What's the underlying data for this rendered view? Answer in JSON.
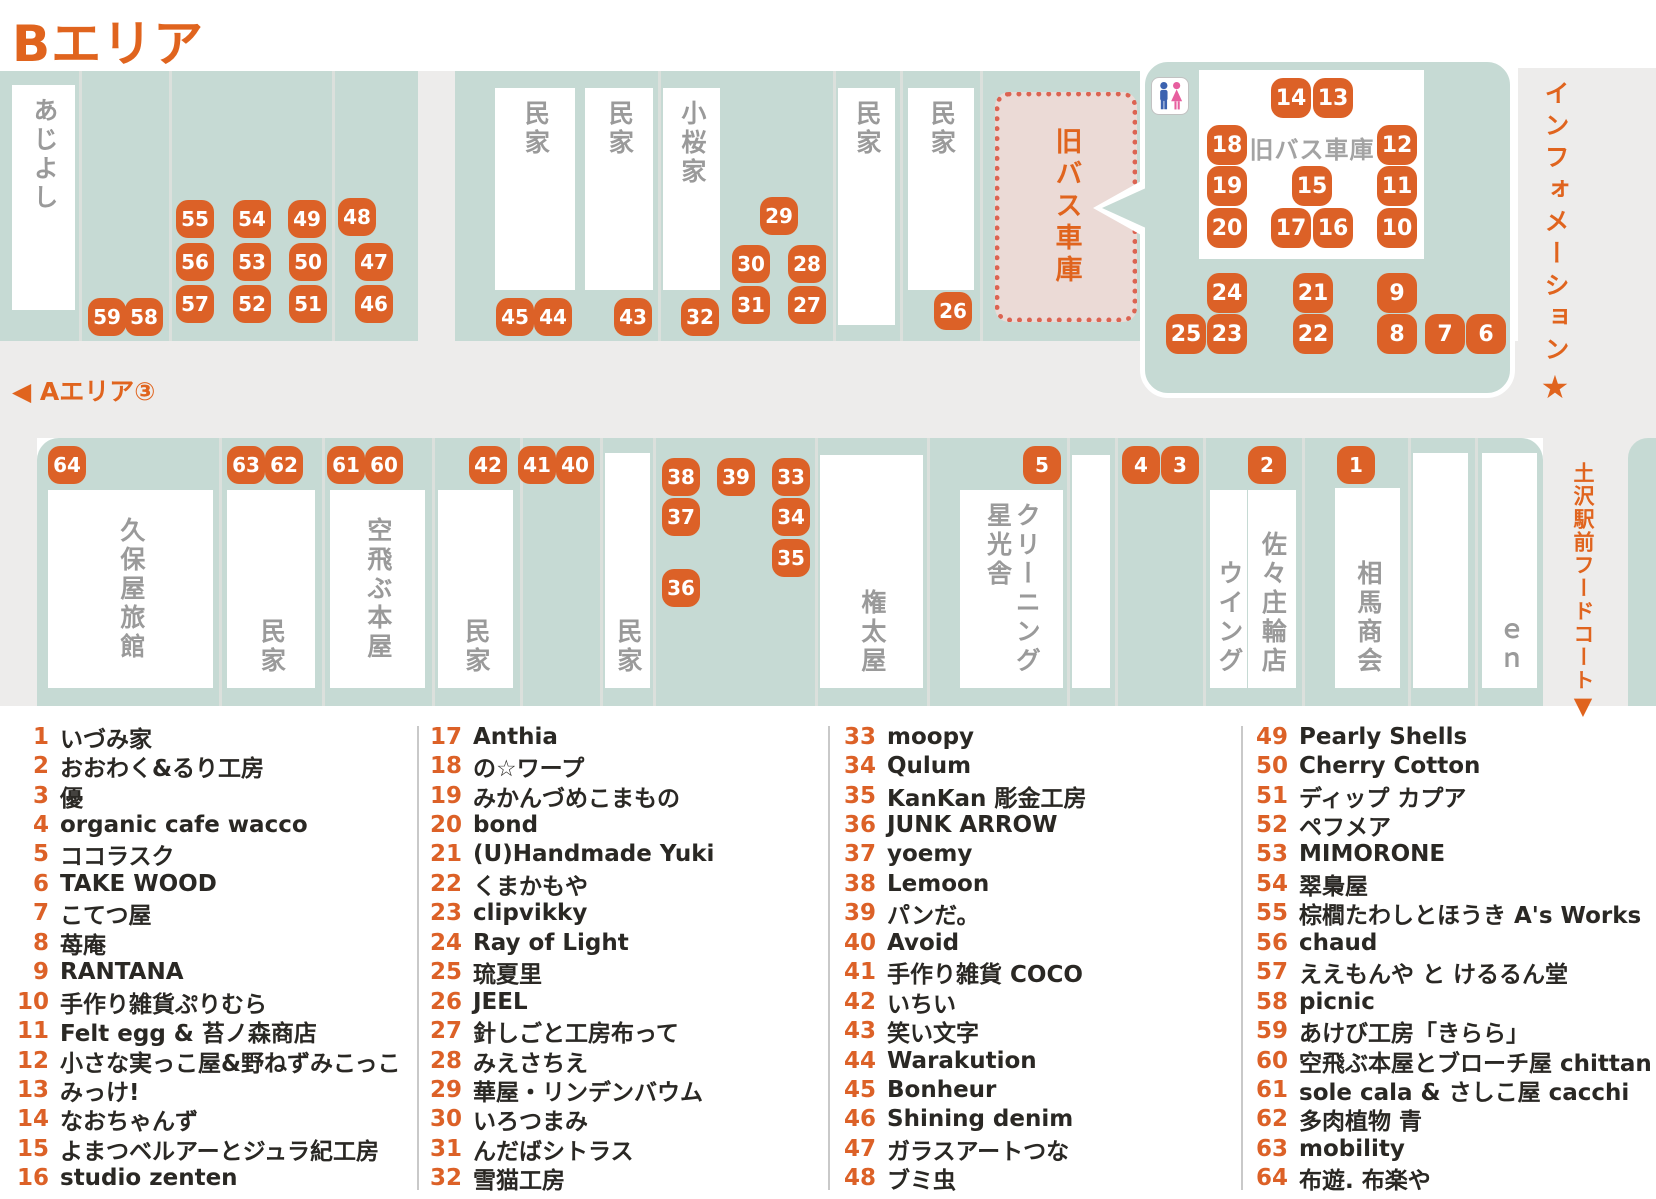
{
  "title": "Bエリア",
  "nav": {
    "a_area_label": "◀ Aエリア③",
    "information_label": "インフォメーション",
    "information_star": "★",
    "foodcourt_label": "土沢駅前フードコート",
    "foodcourt_arrow": "▼"
  },
  "colors": {
    "accent_orange": "#e0641e",
    "badge_orange": "#dc6127",
    "street_teal": "#c6dad4",
    "road_gray": "#edeceb",
    "garage_pink_fill": "#ebdad6",
    "garage_pink_dot": "#dc6351",
    "building_text_gray": "#9a9a9a",
    "legend_text": "#2a2824",
    "restroom_blue": "#3c63b0",
    "restroom_pink": "#e75f9f"
  },
  "map": {
    "bus_garage": {
      "label": "旧バス車庫"
    },
    "callout": {
      "building_label": "旧バス車庫",
      "toilet_icon": "male-female-restroom-icon"
    },
    "roads": [
      {
        "x": 418,
        "y": 71,
        "w": 37,
        "h": 270
      },
      {
        "x": 0,
        "y": 341,
        "w": 1656,
        "h": 97
      },
      {
        "x": 1518,
        "y": 68,
        "w": 138,
        "h": 273
      },
      {
        "x": 1543,
        "y": 438,
        "w": 113,
        "h": 268
      },
      {
        "x": 0,
        "y": 438,
        "w": 37,
        "h": 268
      }
    ],
    "teal_blocks": [
      {
        "x": 0,
        "y": 71,
        "w": 418,
        "h": 270
      },
      {
        "x": 455,
        "y": 71,
        "w": 525,
        "h": 270
      },
      {
        "x": 980,
        "y": 71,
        "w": 160,
        "h": 270
      },
      {
        "x": 37,
        "y": 438,
        "w": 1506,
        "h": 268,
        "r": "22px 22px 0 0"
      },
      {
        "x": 1628,
        "y": 438,
        "w": 28,
        "h": 268,
        "r": "20px 0 0 0"
      }
    ],
    "dividers": [
      {
        "x": 79,
        "y": 71,
        "h": 270
      },
      {
        "x": 169,
        "y": 71,
        "h": 270
      },
      {
        "x": 332,
        "y": 71,
        "h": 270
      },
      {
        "x": 658,
        "y": 71,
        "h": 270
      },
      {
        "x": 833,
        "y": 71,
        "h": 270
      },
      {
        "x": 900,
        "y": 71,
        "h": 270
      },
      {
        "x": 980,
        "y": 71,
        "h": 270
      },
      {
        "x": 219,
        "y": 438,
        "h": 268
      },
      {
        "x": 322,
        "y": 438,
        "h": 268
      },
      {
        "x": 432,
        "y": 438,
        "h": 268
      },
      {
        "x": 520,
        "y": 438,
        "h": 268
      },
      {
        "x": 600,
        "y": 438,
        "h": 268
      },
      {
        "x": 653,
        "y": 438,
        "h": 268
      },
      {
        "x": 815,
        "y": 438,
        "h": 268
      },
      {
        "x": 927,
        "y": 438,
        "h": 268
      },
      {
        "x": 1067,
        "y": 438,
        "h": 268
      },
      {
        "x": 1115,
        "y": 438,
        "h": 268
      },
      {
        "x": 1203,
        "y": 438,
        "h": 268
      },
      {
        "x": 1302,
        "y": 438,
        "h": 268
      },
      {
        "x": 1408,
        "y": 438,
        "h": 268
      },
      {
        "x": 1475,
        "y": 438,
        "h": 268
      }
    ],
    "buildings": [
      {
        "id": "ajiyoshi",
        "label": "あじよし",
        "x": 12,
        "y": 85,
        "w": 63,
        "h": 225,
        "align": "top"
      },
      {
        "id": "minka-t1",
        "label": "民家",
        "x": 495,
        "y": 88,
        "w": 80,
        "h": 202,
        "align": "top"
      },
      {
        "id": "minka-t2",
        "label": "民家",
        "x": 585,
        "y": 88,
        "w": 68,
        "h": 202,
        "align": "top"
      },
      {
        "id": "kozakuraya",
        "label": "小桜家",
        "x": 663,
        "y": 88,
        "w": 57,
        "h": 202,
        "align": "top"
      },
      {
        "id": "minka-t3",
        "label": "民家",
        "x": 838,
        "y": 88,
        "w": 57,
        "h": 237,
        "align": "top"
      },
      {
        "id": "minka-t4",
        "label": "民家",
        "x": 908,
        "y": 88,
        "w": 66,
        "h": 202,
        "align": "top"
      },
      {
        "id": "kuboya-ryokan",
        "label": "久保屋旅館",
        "x": 48,
        "y": 490,
        "w": 165,
        "h": 198,
        "align": "center"
      },
      {
        "id": "minka-b1",
        "label": "民家",
        "x": 227,
        "y": 490,
        "w": 88,
        "h": 198,
        "align": "bottom"
      },
      {
        "id": "soratobu-honya",
        "label": "空飛ぶ本屋",
        "x": 330,
        "y": 490,
        "w": 95,
        "h": 198,
        "align": "center"
      },
      {
        "id": "minka-b2",
        "label": "民家",
        "x": 438,
        "y": 490,
        "w": 75,
        "h": 198,
        "align": "bottom"
      },
      {
        "id": "minka-b3",
        "label": "民家",
        "x": 605,
        "y": 453,
        "w": 45,
        "h": 235,
        "align": "bottom"
      },
      {
        "id": "gontaya",
        "label": "権太屋",
        "x": 820,
        "y": 455,
        "w": 103,
        "h": 233,
        "align": "bottom"
      },
      {
        "id": "cleaning-seikosha",
        "label": "クリーニング\n星光舎",
        "x": 960,
        "y": 490,
        "w": 103,
        "h": 198,
        "align": "bottom"
      },
      {
        "id": "unlabeled-1",
        "label": "",
        "x": 1072,
        "y": 455,
        "w": 38,
        "h": 233,
        "align": "bottom"
      },
      {
        "id": "wing",
        "label": "ウイング",
        "x": 1210,
        "y": 490,
        "w": 37,
        "h": 198,
        "align": "bottom"
      },
      {
        "id": "sasasho-rinten",
        "label": "佐々庄輪店",
        "x": 1248,
        "y": 490,
        "w": 48,
        "h": 198,
        "align": "bottom"
      },
      {
        "id": "soma-shokai",
        "label": "相馬商会",
        "x": 1335,
        "y": 488,
        "w": 65,
        "h": 200,
        "align": "bottom"
      },
      {
        "id": "unlabeled-2",
        "label": "",
        "x": 1413,
        "y": 453,
        "w": 55,
        "h": 235,
        "align": "bottom"
      },
      {
        "id": "en",
        "label": "ｅｎ",
        "x": 1482,
        "y": 453,
        "w": 55,
        "h": 235,
        "align": "bottom"
      }
    ],
    "badges": [
      {
        "n": 1,
        "x": 1356,
        "y": 465,
        "s": 38
      },
      {
        "n": 2,
        "x": 1267,
        "y": 465,
        "s": 38
      },
      {
        "n": 3,
        "x": 1180,
        "y": 465,
        "s": 38
      },
      {
        "n": 4,
        "x": 1141,
        "y": 465,
        "s": 38
      },
      {
        "n": 5,
        "x": 1042,
        "y": 465,
        "s": 38
      },
      {
        "n": 6,
        "x": 1486,
        "y": 334,
        "s": 40
      },
      {
        "n": 7,
        "x": 1445,
        "y": 334,
        "s": 40
      },
      {
        "n": 8,
        "x": 1397,
        "y": 334,
        "s": 40
      },
      {
        "n": 9,
        "x": 1397,
        "y": 293,
        "s": 40
      },
      {
        "n": 10,
        "x": 1397,
        "y": 228,
        "s": 40
      },
      {
        "n": 11,
        "x": 1397,
        "y": 186,
        "s": 40
      },
      {
        "n": 12,
        "x": 1397,
        "y": 145,
        "s": 40
      },
      {
        "n": 13,
        "x": 1333,
        "y": 98,
        "s": 40
      },
      {
        "n": 14,
        "x": 1291,
        "y": 98,
        "s": 40
      },
      {
        "n": 15,
        "x": 1312,
        "y": 186,
        "s": 40
      },
      {
        "n": 16,
        "x": 1333,
        "y": 228,
        "s": 40
      },
      {
        "n": 17,
        "x": 1291,
        "y": 228,
        "s": 40
      },
      {
        "n": 18,
        "x": 1227,
        "y": 145,
        "s": 40
      },
      {
        "n": 19,
        "x": 1227,
        "y": 186,
        "s": 40
      },
      {
        "n": 20,
        "x": 1227,
        "y": 228,
        "s": 40
      },
      {
        "n": 21,
        "x": 1313,
        "y": 293,
        "s": 40
      },
      {
        "n": 22,
        "x": 1313,
        "y": 334,
        "s": 40
      },
      {
        "n": 23,
        "x": 1227,
        "y": 334,
        "s": 40
      },
      {
        "n": 24,
        "x": 1227,
        "y": 293,
        "s": 40
      },
      {
        "n": 25,
        "x": 1186,
        "y": 334,
        "s": 40
      },
      {
        "n": 26,
        "x": 953,
        "y": 311,
        "s": 38
      },
      {
        "n": 27,
        "x": 807,
        "y": 305,
        "s": 38
      },
      {
        "n": 28,
        "x": 807,
        "y": 264,
        "s": 38
      },
      {
        "n": 29,
        "x": 779,
        "y": 216,
        "s": 38
      },
      {
        "n": 30,
        "x": 751,
        "y": 264,
        "s": 38
      },
      {
        "n": 31,
        "x": 751,
        "y": 305,
        "s": 38
      },
      {
        "n": 32,
        "x": 700,
        "y": 317,
        "s": 38
      },
      {
        "n": 33,
        "x": 791,
        "y": 477,
        "s": 38
      },
      {
        "n": 34,
        "x": 791,
        "y": 517,
        "s": 38
      },
      {
        "n": 35,
        "x": 791,
        "y": 558,
        "s": 38
      },
      {
        "n": 36,
        "x": 681,
        "y": 588,
        "s": 38
      },
      {
        "n": 37,
        "x": 681,
        "y": 517,
        "s": 38
      },
      {
        "n": 38,
        "x": 681,
        "y": 477,
        "s": 38
      },
      {
        "n": 39,
        "x": 736,
        "y": 477,
        "s": 38
      },
      {
        "n": 40,
        "x": 575,
        "y": 465,
        "s": 38
      },
      {
        "n": 41,
        "x": 537,
        "y": 465,
        "s": 38
      },
      {
        "n": 42,
        "x": 488,
        "y": 465,
        "s": 38
      },
      {
        "n": 43,
        "x": 633,
        "y": 317,
        "s": 38
      },
      {
        "n": 44,
        "x": 553,
        "y": 317,
        "s": 38
      },
      {
        "n": 45,
        "x": 515,
        "y": 317,
        "s": 38
      },
      {
        "n": 46,
        "x": 374,
        "y": 304,
        "s": 38
      },
      {
        "n": 47,
        "x": 374,
        "y": 262,
        "s": 38
      },
      {
        "n": 48,
        "x": 357,
        "y": 217,
        "s": 38
      },
      {
        "n": 49,
        "x": 307,
        "y": 219,
        "s": 38
      },
      {
        "n": 50,
        "x": 308,
        "y": 262,
        "s": 38
      },
      {
        "n": 51,
        "x": 308,
        "y": 304,
        "s": 38
      },
      {
        "n": 52,
        "x": 252,
        "y": 304,
        "s": 38
      },
      {
        "n": 53,
        "x": 252,
        "y": 262,
        "s": 38
      },
      {
        "n": 54,
        "x": 252,
        "y": 219,
        "s": 38
      },
      {
        "n": 55,
        "x": 195,
        "y": 219,
        "s": 38
      },
      {
        "n": 56,
        "x": 195,
        "y": 262,
        "s": 38
      },
      {
        "n": 57,
        "x": 195,
        "y": 304,
        "s": 38
      },
      {
        "n": 58,
        "x": 144,
        "y": 317,
        "s": 38
      },
      {
        "n": 59,
        "x": 107,
        "y": 317,
        "s": 38
      },
      {
        "n": 60,
        "x": 384,
        "y": 465,
        "s": 38
      },
      {
        "n": 61,
        "x": 346,
        "y": 465,
        "s": 38
      },
      {
        "n": 62,
        "x": 284,
        "y": 465,
        "s": 38
      },
      {
        "n": 63,
        "x": 246,
        "y": 465,
        "s": 38
      },
      {
        "n": 64,
        "x": 67,
        "y": 465,
        "s": 38
      }
    ]
  },
  "legend": {
    "divider_x": [
      417,
      828,
      1241
    ],
    "columns": [
      {
        "x": 7,
        "entries": [
          {
            "n": 1,
            "name": "いづみ家"
          },
          {
            "n": 2,
            "name": "おおわく&るり工房"
          },
          {
            "n": 3,
            "name": "優"
          },
          {
            "n": 4,
            "name": "organic cafe wacco"
          },
          {
            "n": 5,
            "name": "ココラスク"
          },
          {
            "n": 6,
            "name": "TAKE WOOD"
          },
          {
            "n": 7,
            "name": "こてつ屋"
          },
          {
            "n": 8,
            "name": "苺庵"
          },
          {
            "n": 9,
            "name": "RANTANA"
          },
          {
            "n": 10,
            "name": "手作り雑貨ぷりむら"
          },
          {
            "n": 11,
            "name": "Felt egg & 苔ノ森商店"
          },
          {
            "n": 12,
            "name": "小さな実っこ屋&野ねずみこっこ"
          },
          {
            "n": 13,
            "name": "みっけ!"
          },
          {
            "n": 14,
            "name": "なおちゃんず"
          },
          {
            "n": 15,
            "name": "よまつベルアーとジュラ紀工房"
          },
          {
            "n": 16,
            "name": "studio zenten"
          }
        ]
      },
      {
        "x": 420,
        "entries": [
          {
            "n": 17,
            "name": "Anthia"
          },
          {
            "n": 18,
            "name": "の☆ワープ"
          },
          {
            "n": 19,
            "name": "みかんづめこまもの"
          },
          {
            "n": 20,
            "name": "bond"
          },
          {
            "n": 21,
            "name": "(U)Handmade Yuki"
          },
          {
            "n": 22,
            "name": "くまかもや"
          },
          {
            "n": 23,
            "name": "clipvikky"
          },
          {
            "n": 24,
            "name": "Ray of Light"
          },
          {
            "n": 25,
            "name": "琉夏里"
          },
          {
            "n": 26,
            "name": "JEEL"
          },
          {
            "n": 27,
            "name": "針しごと工房布って"
          },
          {
            "n": 28,
            "name": "みえさちえ"
          },
          {
            "n": 29,
            "name": "華屋・リンデンバウム"
          },
          {
            "n": 30,
            "name": "いろつまみ"
          },
          {
            "n": 31,
            "name": "んだばシトラス"
          },
          {
            "n": 32,
            "name": "雪猫工房"
          }
        ]
      },
      {
        "x": 834,
        "entries": [
          {
            "n": 33,
            "name": "moopy"
          },
          {
            "n": 34,
            "name": "Qulum"
          },
          {
            "n": 35,
            "name": "KanKan 彫金工房"
          },
          {
            "n": 36,
            "name": "JUNK ARROW"
          },
          {
            "n": 37,
            "name": "yoemy"
          },
          {
            "n": 38,
            "name": "Lemoon"
          },
          {
            "n": 39,
            "name": "パンだ。"
          },
          {
            "n": 40,
            "name": "Avoid"
          },
          {
            "n": 41,
            "name": "手作り雑貨 COCO"
          },
          {
            "n": 42,
            "name": "いちい"
          },
          {
            "n": 43,
            "name": "笑い文字"
          },
          {
            "n": 44,
            "name": "Warakution"
          },
          {
            "n": 45,
            "name": "Bonheur"
          },
          {
            "n": 46,
            "name": "Shining denim"
          },
          {
            "n": 47,
            "name": "ガラスアートつな"
          },
          {
            "n": 48,
            "name": "ブミ虫"
          }
        ]
      },
      {
        "x": 1246,
        "entries": [
          {
            "n": 49,
            "name": "Pearly Shells"
          },
          {
            "n": 50,
            "name": "Cherry Cotton"
          },
          {
            "n": 51,
            "name": "ディップ カプア"
          },
          {
            "n": 52,
            "name": "ペフメア"
          },
          {
            "n": 53,
            "name": "MIMORONE"
          },
          {
            "n": 54,
            "name": "翠梟屋"
          },
          {
            "n": 55,
            "name": "棕櫚たわしとほうき A's Works"
          },
          {
            "n": 56,
            "name": "chaud"
          },
          {
            "n": 57,
            "name": "ええもんや と けるるん堂"
          },
          {
            "n": 58,
            "name": "picnic"
          },
          {
            "n": 59,
            "name": "あけび工房「きらら」"
          },
          {
            "n": 60,
            "name": "空飛ぶ本屋とブローチ屋 chittan"
          },
          {
            "n": 61,
            "name": "sole cala & さしこ屋 cacchi"
          },
          {
            "n": 62,
            "name": "多肉植物 青"
          },
          {
            "n": 63,
            "name": "mobility"
          },
          {
            "n": 64,
            "name": "布遊. 布楽や"
          }
        ]
      }
    ]
  }
}
